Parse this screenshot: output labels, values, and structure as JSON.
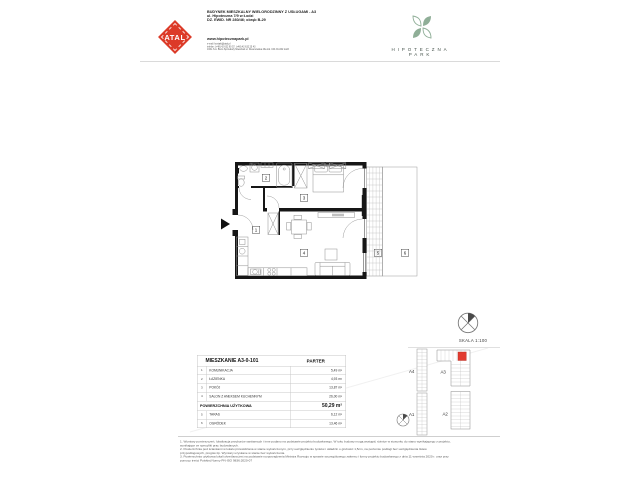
{
  "header": {
    "logo_text": "ATAL",
    "title_line1": "BUDYNEK MIESZKALNY WIELORODZINNY Z USŁUGAMI - A3",
    "title_line2": "ul. Hipoteczna 7/9 w Łodzi",
    "title_line3": "DZ. EWID. NR 280/46; obręb B-29",
    "website": "www.hipotecznapark.pl",
    "contact_line1": "e-mail: kontakt@atal.pl",
    "contact_line2": "telefon: (+48) 42 632 90 57, (+48) 42 632 25 43",
    "contact_line3": "ATAL S.A. Biuro Sprzedaży Mieszkań ul. Drewnowska 43a lok. U01 91-002 Łódź",
    "brand": "HIPOTECZNA PARK"
  },
  "colors": {
    "atal_red": "#dc3a28",
    "leaf_green": "#8fae97",
    "highlight_red": "#e23b30"
  },
  "floor_plan": {
    "room_labels": [
      "1",
      "2",
      "3",
      "4",
      "5",
      "6"
    ]
  },
  "scale": {
    "label": "SKALA 1:100"
  },
  "table": {
    "title": "MIESZKANIE A3-0-101",
    "floor": "PARTER",
    "rows": [
      {
        "no": "1",
        "name": "KOMUNIKACJA",
        "area": "5,49 m²"
      },
      {
        "no": "2",
        "name": "ŁAZIENKA",
        "area": "4,93 m²"
      },
      {
        "no": "3",
        "name": "POKÓJ",
        "area": "13,87 m²"
      },
      {
        "no": "4",
        "name": "SALON Z ANEKSEM KUCHENNYM",
        "area": "26,00 m²"
      }
    ],
    "total": {
      "label": "POWIERZCHNIA UŻYTKOWA",
      "area": "50,29 m²"
    },
    "outdoor": [
      {
        "no": "5",
        "name": "TARAS",
        "area": "6,12 m²"
      },
      {
        "no": "6",
        "name": "OGRÓDEK",
        "area": "13,46 m²"
      }
    ]
  },
  "key_plan": {
    "labels": {
      "a4": "A4",
      "a1": "A1",
      "a3": "A3",
      "a2": "A2"
    }
  },
  "footnotes": [
    "1. Wymiary pomieszczeń, lokalizacja przyborów sanitarnych i inne podano na podstawie projektu budowlanego. W toku budowy mogą wystąpić różnice w stosunku do stanu wynikającego z projektu,",
    "wynikające ze specyfiki prac budowlanych.",
    "2. Powierzchnia pod ściankami w lokalu przewidziana w stanie wykończonym, przy uwzględnieniu tynków i okładzin o grubości 1,5cm, na poziomie podłogi bez uwzględnienia listew",
    "przypodłogowych, progów itp. Wymiary uzyskane w stanie bez wykończenia.",
    "3. Powierzchnia użytkowa lokali określana jest na podstawie rozporządzenia Ministra Rozwoju w sprawie szczegółowego zakresu i formy projektu budowlanego z dnia 11 września 2020 r. oraz przy",
    "pomocy treści Polskiej Normy PN-ISO 9836:2020-07"
  ]
}
